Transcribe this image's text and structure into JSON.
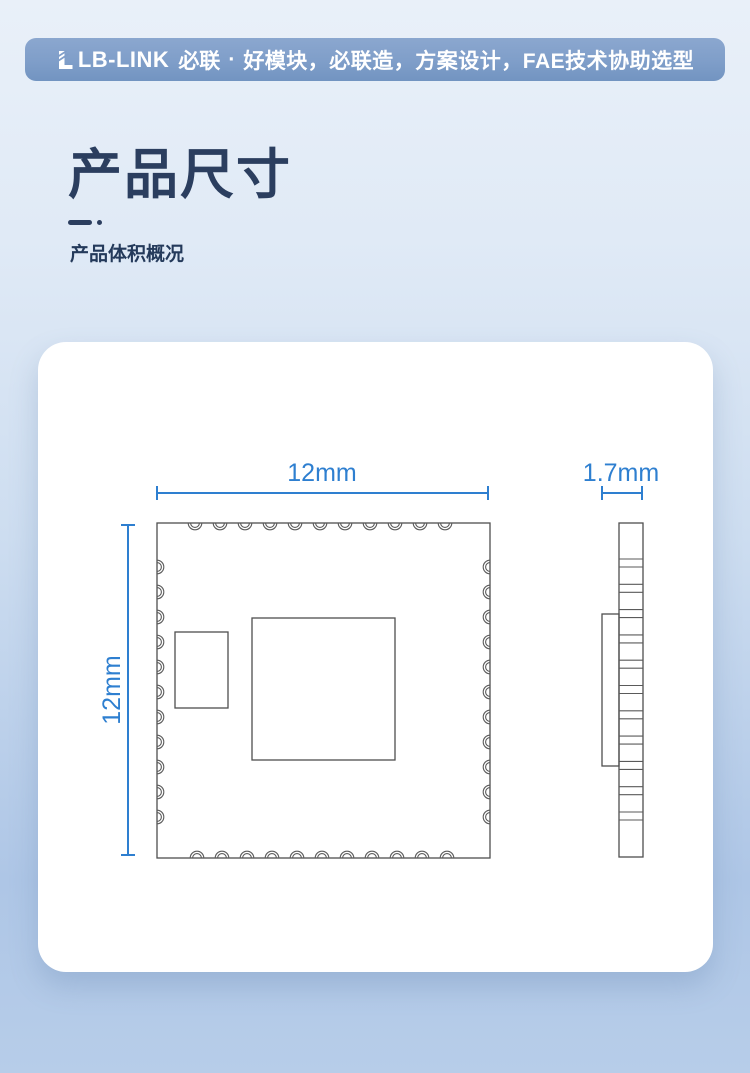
{
  "header": {
    "logo": "LB-LINK",
    "brand": "必联",
    "separator": "·",
    "tagline": "好模块，必联造，方案设计，FAE技术协助选型"
  },
  "section": {
    "title": "产品尺寸",
    "subtitle": "产品体积概况"
  },
  "diagram": {
    "top_view_width_label": "12mm",
    "side_height_label": "12mm",
    "thickness_label": "1.7mm"
  },
  "colors": {
    "accent_blue": "#2e7fd0",
    "title_navy": "#2b3e5f",
    "banner_blue": "#7f9ec9",
    "drawing_line_gray": "#4f4f4f",
    "card_white": "#ffffff"
  }
}
